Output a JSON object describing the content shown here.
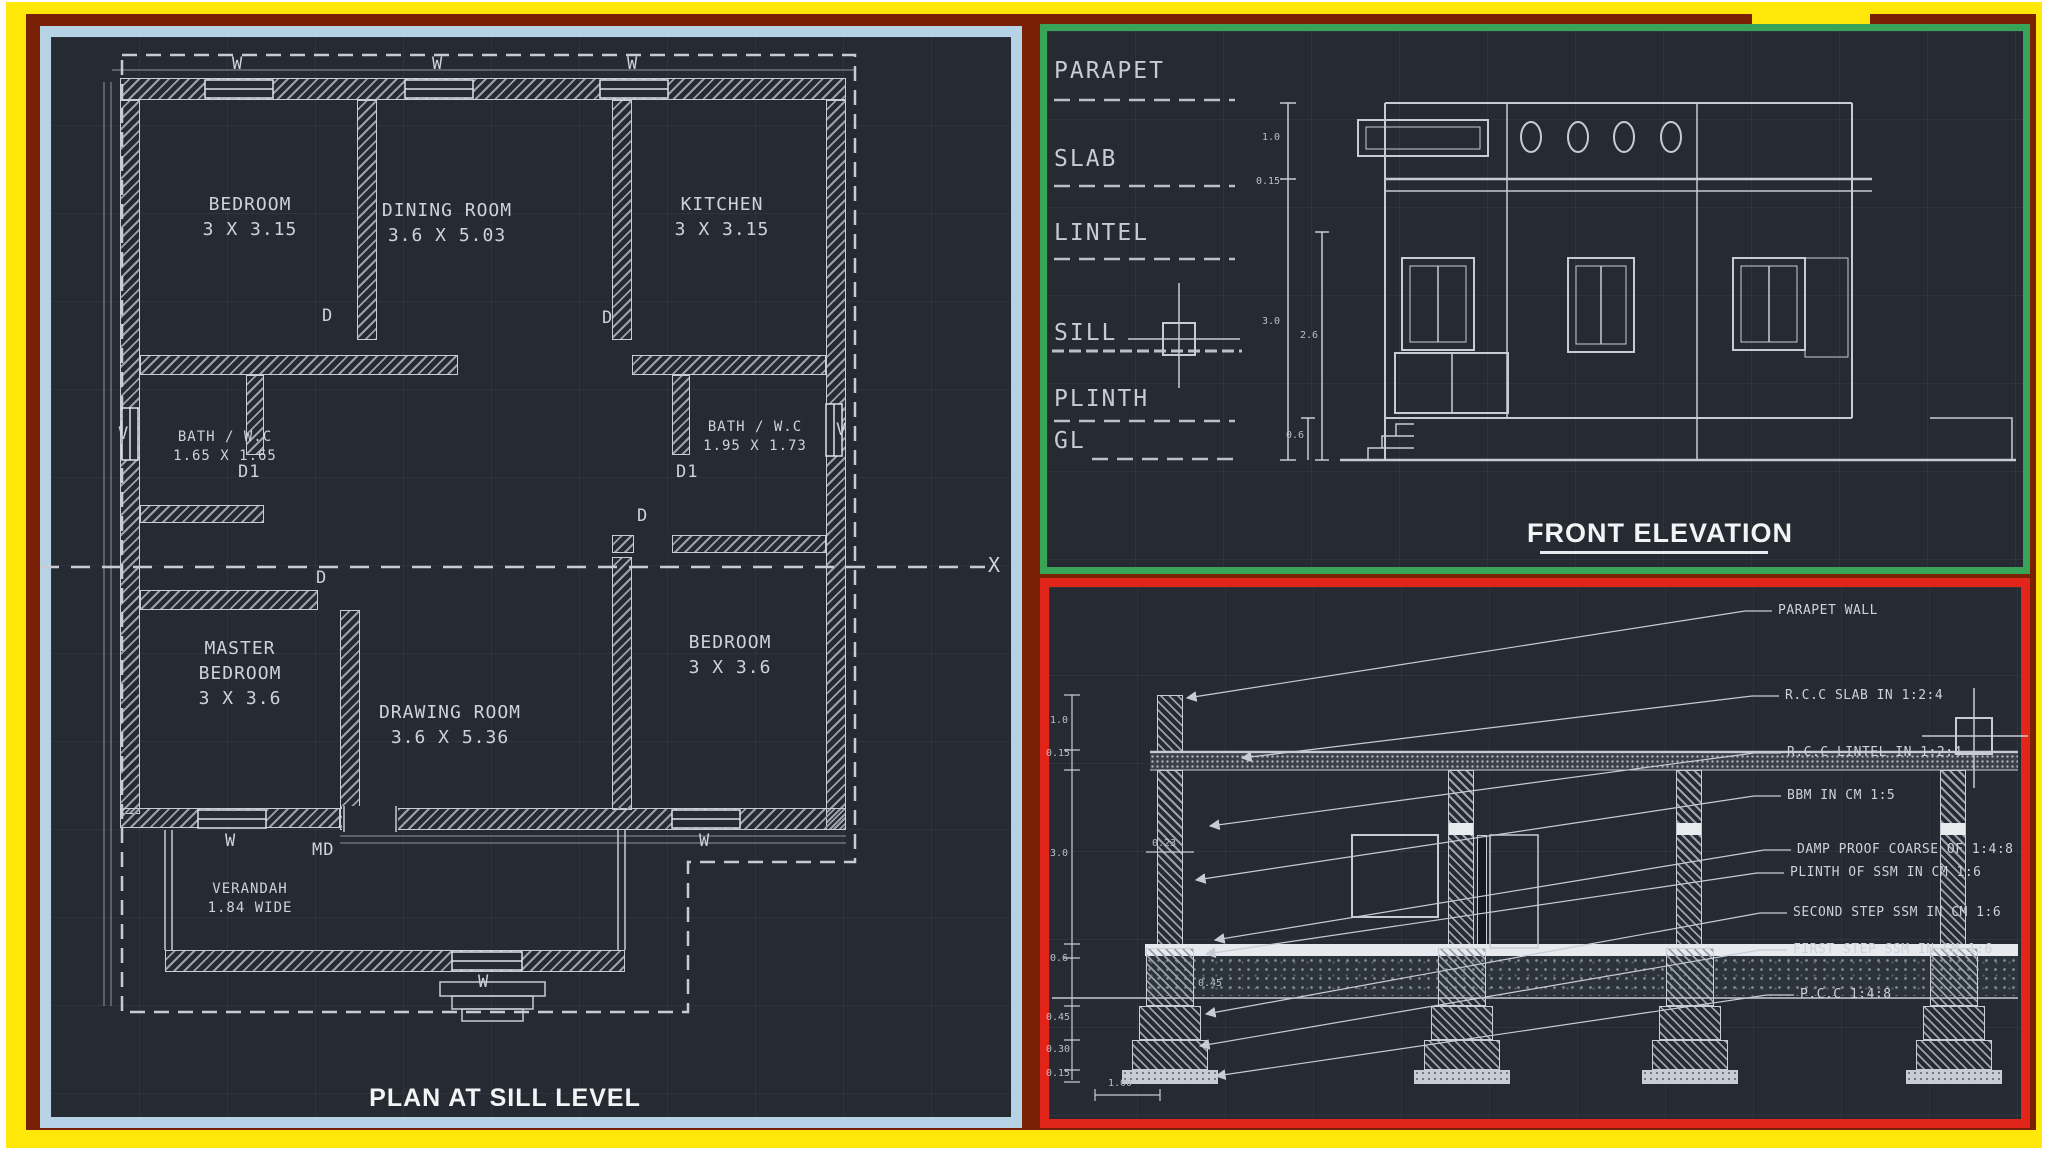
{
  "sheet": {
    "type": "cad-drawing-sheet",
    "colors": {
      "canvas": "#262b33",
      "line": "#c9ced6",
      "outer_frame": "#ffe70a",
      "inner_frame": "#7a2004",
      "plan_frame": "#b5d3e4",
      "elevation_frame": "#38a457",
      "section_frame": "#e1251b"
    }
  },
  "plan": {
    "title": "PLAN AT SILL LEVEL",
    "rooms": {
      "bedroom1": {
        "name": "BEDROOM",
        "dims": "3 X 3.15"
      },
      "dining": {
        "name": "DINING ROOM",
        "dims": "3.6 X 5.03"
      },
      "kitchen": {
        "name": "KITCHEN",
        "dims": "3 X 3.15"
      },
      "bath1": {
        "name": "BATH / W.C",
        "dims": "1.65 X 1.65"
      },
      "bath2": {
        "name": "BATH / W.C",
        "dims": "1.95 X 1.73"
      },
      "master": {
        "name": "MASTER BEDROOM",
        "dims": "3 X 3.6"
      },
      "drawing": {
        "name": "DRAWING ROOM",
        "dims": "3.6 X 5.36"
      },
      "bedroom2": {
        "name": "BEDROOM",
        "dims": "3 X 3.6"
      },
      "verandah": {
        "name": "VERANDAH",
        "dims": "1.84 WIDE"
      }
    },
    "marks": {
      "d": "D",
      "d1": "D1",
      "md": "MD",
      "w": "W",
      "v": "V",
      "x": "X"
    }
  },
  "elevation": {
    "title": "FRONT ELEVATION",
    "levels": [
      "PARAPET",
      "SLAB",
      "LINTEL",
      "SILL",
      "PLINTH",
      "GL"
    ],
    "dims": {
      "parapet": "1.0",
      "slab": "0.15",
      "wall": "3.0",
      "sill": "2.6",
      "plinth": "0.6"
    }
  },
  "section": {
    "callouts": [
      "PARAPET WALL",
      "R.C.C SLAB IN 1:2:4",
      "R.C.C LINTEL IN 1:2:4",
      "BBM IN CM 1:5",
      "DAMP PROOF COARSE OF 1:4:8",
      "PLINTH OF SSM IN CM 1:6",
      "SECOND STEP SSM IN CM 1:6",
      "FIRST STEP SSM IN CM 1:6",
      "P.C.C 1:4:8"
    ],
    "dims": {
      "parapet": "1.0",
      "slab": "0.15",
      "wall": "3.0",
      "plinth": "0.6",
      "step1": "0.45",
      "step2": "0.30",
      "step3": "0.15",
      "thk": "0.23",
      "footing": "0.45",
      "base": "1.00"
    }
  }
}
